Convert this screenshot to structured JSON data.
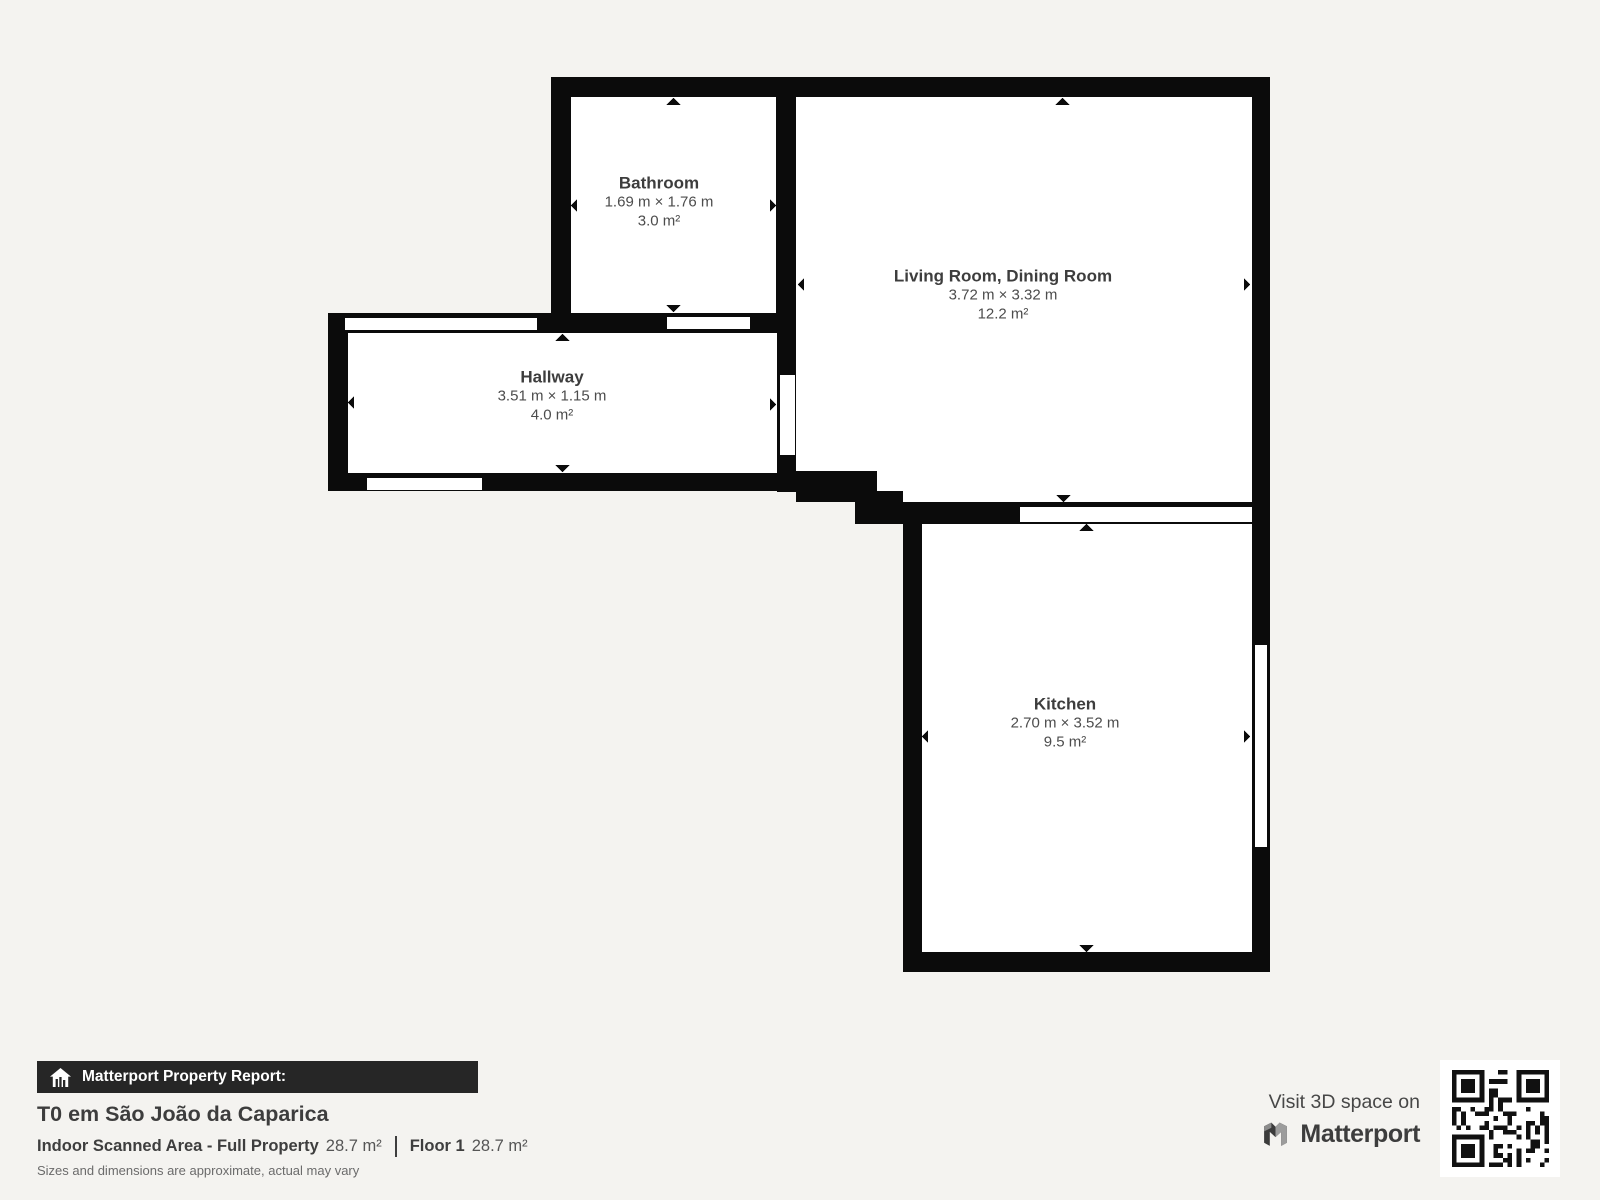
{
  "rooms": {
    "bathroom": {
      "name": "Bathroom",
      "dimensions": "1.69 m × 1.76 m",
      "area": "3.0 m²"
    },
    "living": {
      "name": "Living Room, Dining Room",
      "dimensions": "3.72 m × 3.32 m",
      "area": "12.2 m²"
    },
    "hallway": {
      "name": "Hallway",
      "dimensions": "3.51 m × 1.15 m",
      "area": "4.0 m²"
    },
    "kitchen": {
      "name": "Kitchen",
      "dimensions": "2.70 m × 3.52 m",
      "area": "9.5 m²"
    }
  },
  "report": {
    "badge": "Matterport Property Report:",
    "property_title": "T0 em São João da Caparica",
    "indoor_area_label": "Indoor Scanned Area - Full Property",
    "indoor_area_value": "28.7 m²",
    "floor_label": "Floor 1",
    "floor_value": "28.7 m²",
    "disclaimer": "Sizes and dimensions are approximate, actual may vary"
  },
  "branding": {
    "visit_text": "Visit 3D space on",
    "brand_name": "Matterport"
  },
  "icons": {
    "badge_icon": "house-chart-icon",
    "logo_icon": "matterport-m-icon",
    "qr": "qr-code"
  },
  "colors": {
    "background": "#f4f3f0",
    "wall": "#0b0b0b",
    "room_fill": "#ffffff",
    "badge_bar": "#262626",
    "text_dark": "#3d3d3d",
    "text_mid": "#4c4c4c",
    "text_light": "#6b6b6b"
  }
}
